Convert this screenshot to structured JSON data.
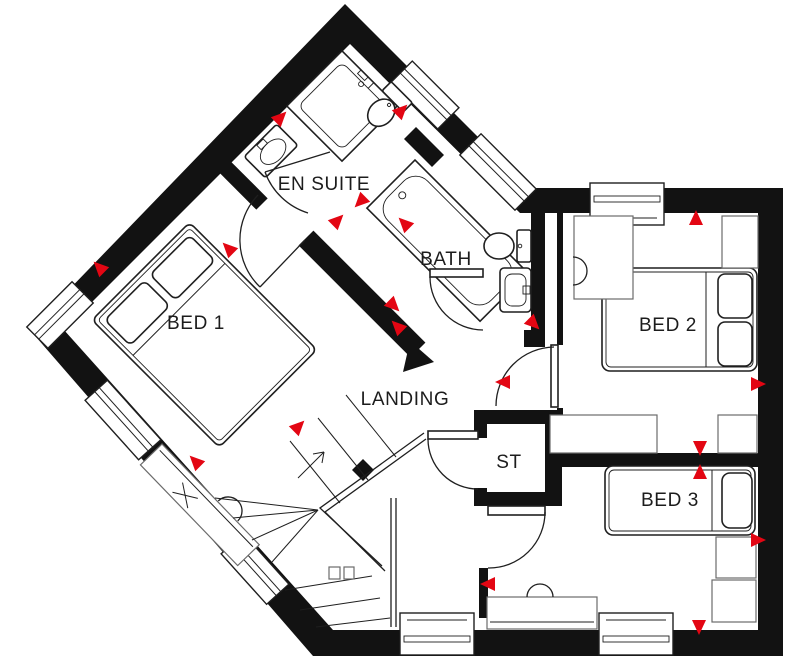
{
  "plan": {
    "kind": "house-floor-plan",
    "floor_shape": "rectangular wing with 45-degree rotated wing at upper left"
  },
  "colors": {
    "wall": "#121212",
    "line": "#1f1f1f",
    "marker": "#e30613",
    "background": "#ffffff"
  },
  "rooms": [
    {
      "id": "bed1",
      "label": "BED 1"
    },
    {
      "id": "ensuite",
      "label": "EN SUITE"
    },
    {
      "id": "bath",
      "label": "BATH"
    },
    {
      "id": "landing",
      "label": "LANDING"
    },
    {
      "id": "store",
      "label": "ST"
    },
    {
      "id": "bed2",
      "label": "BED 2"
    },
    {
      "id": "bed3",
      "label": "BED 3"
    }
  ],
  "fixtures": {
    "bed1": "double bed with two pillows (rotated 45°), desk with chair",
    "bed2": "double bed with two pillows, wardrobes, radiator",
    "bed3": "single bed with one pillow, wardrobes, desk with chair",
    "ensuite": "corner shower, wash basin, wc",
    "bath": "bathtub, wc, wash basin",
    "stairs": "winder staircase with up arrow and handrail"
  },
  "markers": [
    {
      "x": 280,
      "y": 118,
      "r": -45
    },
    {
      "x": 401,
      "y": 111,
      "r": -45
    },
    {
      "x": 361,
      "y": 201,
      "r": 135
    },
    {
      "x": 337,
      "y": 221,
      "r": -45
    },
    {
      "x": 100,
      "y": 268,
      "r": -135
    },
    {
      "x": 229,
      "y": 249,
      "r": -135
    },
    {
      "x": 196,
      "y": 462,
      "r": -135
    },
    {
      "x": 298,
      "y": 427,
      "r": -45
    },
    {
      "x": 393,
      "y": 305,
      "r": 45
    },
    {
      "x": 398,
      "y": 327,
      "r": -135
    },
    {
      "x": 533,
      "y": 323,
      "r": 45
    },
    {
      "x": 504,
      "y": 382,
      "r": 180
    },
    {
      "x": 696,
      "y": 219,
      "r": -90
    },
    {
      "x": 757,
      "y": 384,
      "r": 0
    },
    {
      "x": 700,
      "y": 447,
      "r": 90
    },
    {
      "x": 700,
      "y": 473,
      "r": -90
    },
    {
      "x": 757,
      "y": 540,
      "r": 0
    },
    {
      "x": 699,
      "y": 626,
      "r": 90
    },
    {
      "x": 489,
      "y": 584,
      "r": 180
    },
    {
      "x": 405,
      "y": 224,
      "r": -135
    }
  ]
}
